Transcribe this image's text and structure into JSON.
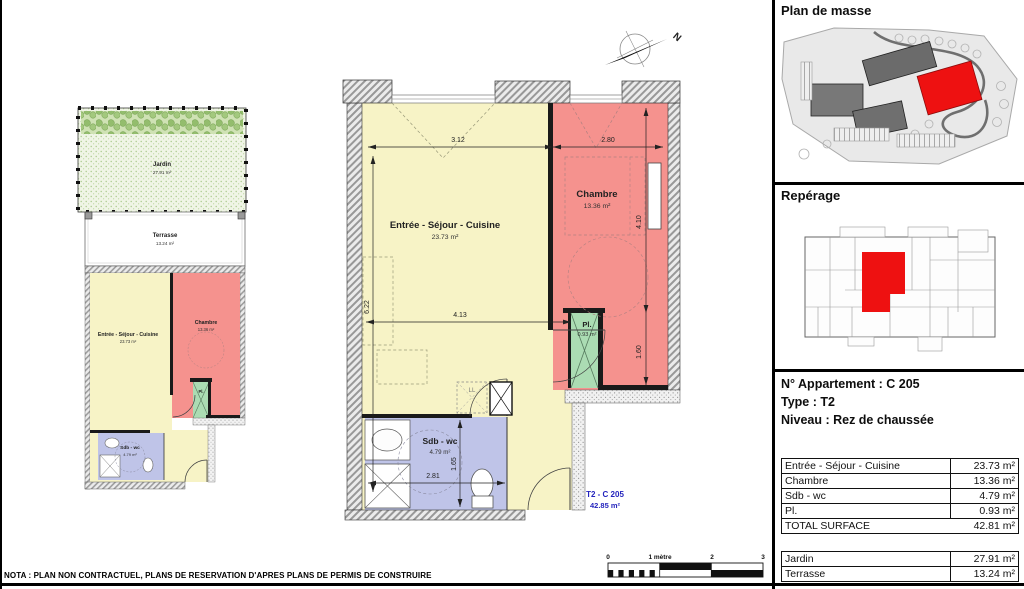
{
  "nota": "NOTA : PLAN NON CONTRACTUEL, PLANS DE RESERVATION D'APRES PLANS DE PERMIS DE CONSTRUIRE",
  "north": {
    "label": "N"
  },
  "scale_bar": {
    "labels": [
      "0",
      "1 mètre",
      "2",
      "3"
    ]
  },
  "sidebar": {
    "plan_de_masse_title": "Plan de masse",
    "reperage_title": "Repérage",
    "apartment": {
      "number_label": "N° Appartement : C 205",
      "type_label": "Type : T2",
      "level_label": "Niveau : Rez de chaussée"
    },
    "surface_table": {
      "rows": [
        {
          "label": "Entrée - Séjour - Cuisine",
          "value": "23.73 m²"
        },
        {
          "label": "Chambre",
          "value": "13.36 m²"
        },
        {
          "label": "Sdb - wc",
          "value": "4.79 m²"
        },
        {
          "label": "Pl.",
          "value": "0.93 m²"
        }
      ],
      "total": {
        "label": "TOTAL SURFACE",
        "value": "42.81 m²"
      }
    },
    "exterior_table": {
      "rows": [
        {
          "label": "Jardin",
          "value": "27.91 m²"
        },
        {
          "label": "Terrasse",
          "value": "13.24 m²"
        }
      ]
    }
  },
  "main_plan": {
    "rooms": {
      "sejour": {
        "name": "Entrée - Séjour - Cuisine",
        "area": "23.73 m²"
      },
      "chambre": {
        "name": "Chambre",
        "area": "13.36 m²"
      },
      "pl": {
        "name": "Pl.",
        "area": "0.93 m²"
      },
      "sdb": {
        "name": "Sdb - wc",
        "area": "4.79 m²"
      }
    },
    "unit_label": {
      "line1": "T2 - C 205",
      "line2": "42.85 m²"
    },
    "dimensions": {
      "top_left": "3.12",
      "top_right": "2.80",
      "left_height": "6.22",
      "chambre_height": "4.10",
      "mid_width": "4.13",
      "right_lower": "1.60",
      "sdb_height": "1.65",
      "sdb_width": "2.81"
    },
    "fixtures": {
      "washer_label": "LL"
    }
  },
  "small_plan": {
    "jardin": {
      "name": "Jardin",
      "area": "27.91 m²"
    },
    "terrasse": {
      "name": "Terrasse",
      "area": "13.24 m²"
    },
    "rooms": {
      "sejour": {
        "name": "Entrée - Séjour - Cuisine",
        "area": "23.73 m²"
      },
      "chambre": {
        "name": "Chambre",
        "area": "13.36 m²"
      },
      "pl": {
        "name": "Pl."
      },
      "sdb": {
        "name": "Sdb - wc",
        "area": "4.79 m²"
      }
    }
  },
  "colors": {
    "room_yellow": "#f7f3c6",
    "room_red": "#f5928e",
    "room_green": "#abdcb3",
    "room_blue": "#bfc4e8",
    "highlight_red": "#ee1111",
    "unit_label_blue": "#2424bd"
  }
}
